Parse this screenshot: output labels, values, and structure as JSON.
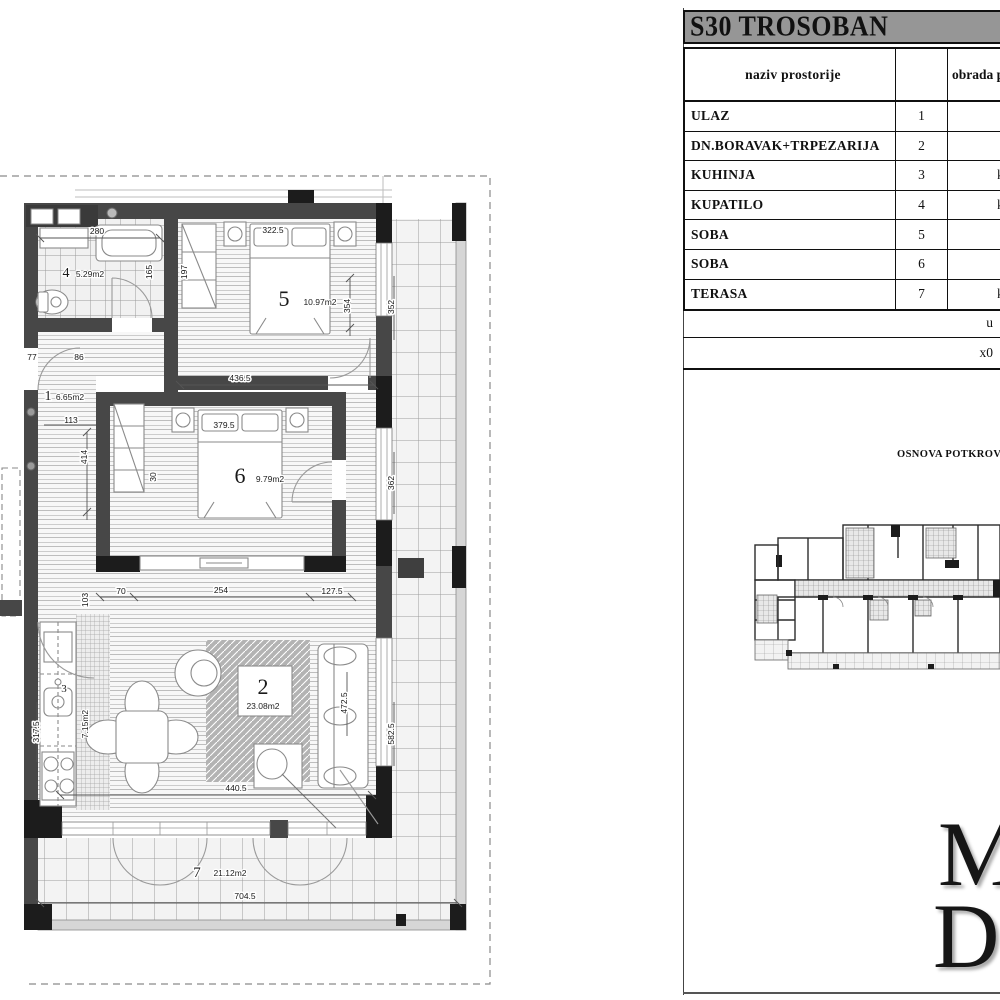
{
  "panel": {
    "title": "S30 TROSOBAN",
    "table": {
      "headers": {
        "name": "naziv prostorije",
        "num": "",
        "finish": "obrada p"
      },
      "rows": [
        {
          "name": "ULAZ",
          "num": "1",
          "finish": "park"
        },
        {
          "name": "DN.BORAVAK+TRPEZARIJA",
          "num": "2",
          "finish": "park"
        },
        {
          "name": "KUHINJA",
          "num": "3",
          "finish": "ker.plo"
        },
        {
          "name": "KUPATILO",
          "num": "4",
          "finish": "ker.plo"
        },
        {
          "name": "SOBA",
          "num": "5",
          "finish": "park"
        },
        {
          "name": "SOBA",
          "num": "6",
          "finish": "park"
        },
        {
          "name": "TERASA",
          "num": "7",
          "finish": "ker.plo"
        }
      ],
      "total_label": "u",
      "scale_label": "x0"
    },
    "keyplan_title": "OSNOVA POTKROV",
    "logo": {
      "line1": "M",
      "line2": "D"
    }
  },
  "plan": {
    "room_labels": [
      {
        "num": "1",
        "x": 48,
        "y": 400,
        "size": 14,
        "area": "6.65m2",
        "ax": 70,
        "ay": 400
      },
      {
        "num": "2",
        "x": 263,
        "y": 694,
        "size": 22,
        "area": "23.08m2",
        "ax": 263,
        "ay": 709
      },
      {
        "num": "3",
        "x": 64,
        "y": 692,
        "size": 11,
        "area": "7.15m2",
        "ax": 88,
        "ay": 724,
        "arot": -90
      },
      {
        "num": "4",
        "x": 66,
        "y": 277,
        "size": 14,
        "area": "5.29m2",
        "ax": 90,
        "ay": 277
      },
      {
        "num": "5",
        "x": 284,
        "y": 306,
        "size": 22,
        "area": "10.97m2",
        "ax": 320,
        "ay": 305
      },
      {
        "num": "6",
        "x": 240,
        "y": 483,
        "size": 22,
        "area": "9.79m2",
        "ax": 270,
        "ay": 482
      },
      {
        "num": "7",
        "x": 197,
        "y": 877,
        "size": 15,
        "area": "21.12m2",
        "ax": 230,
        "ay": 876
      }
    ],
    "dim_labels": [
      {
        "text": "280",
        "x": 97,
        "y": 234
      },
      {
        "text": "322.5",
        "x": 273,
        "y": 233
      },
      {
        "text": "165",
        "x": 152,
        "y": 272,
        "rot": -90
      },
      {
        "text": "197",
        "x": 187,
        "y": 272,
        "rot": -90
      },
      {
        "text": "354",
        "x": 350,
        "y": 306,
        "rot": -90
      },
      {
        "text": "352",
        "x": 394,
        "y": 307,
        "rot": -90
      },
      {
        "text": "436.5",
        "x": 240,
        "y": 381
      },
      {
        "text": "77",
        "x": 32,
        "y": 360
      },
      {
        "text": "86",
        "x": 79,
        "y": 360
      },
      {
        "text": "113",
        "x": 71,
        "y": 423
      },
      {
        "text": "414",
        "x": 87,
        "y": 457,
        "rot": -90
      },
      {
        "text": "379.5",
        "x": 224,
        "y": 428
      },
      {
        "text": "30",
        "x": 156,
        "y": 477,
        "rot": -90
      },
      {
        "text": "70",
        "x": 121,
        "y": 594
      },
      {
        "text": "254",
        "x": 221,
        "y": 593
      },
      {
        "text": "127.5",
        "x": 332,
        "y": 594
      },
      {
        "text": "103",
        "x": 88,
        "y": 600,
        "rot": -90
      },
      {
        "text": "362",
        "x": 394,
        "y": 483,
        "rot": -90
      },
      {
        "text": "317.5",
        "x": 39,
        "y": 732,
        "rot": -90
      },
      {
        "text": "440.5",
        "x": 236,
        "y": 791
      },
      {
        "text": "472.5",
        "x": 347,
        "y": 703,
        "rot": -90
      },
      {
        "text": "582.5",
        "x": 394,
        "y": 734,
        "rot": -90
      },
      {
        "text": "704.5",
        "x": 245,
        "y": 899
      }
    ]
  }
}
